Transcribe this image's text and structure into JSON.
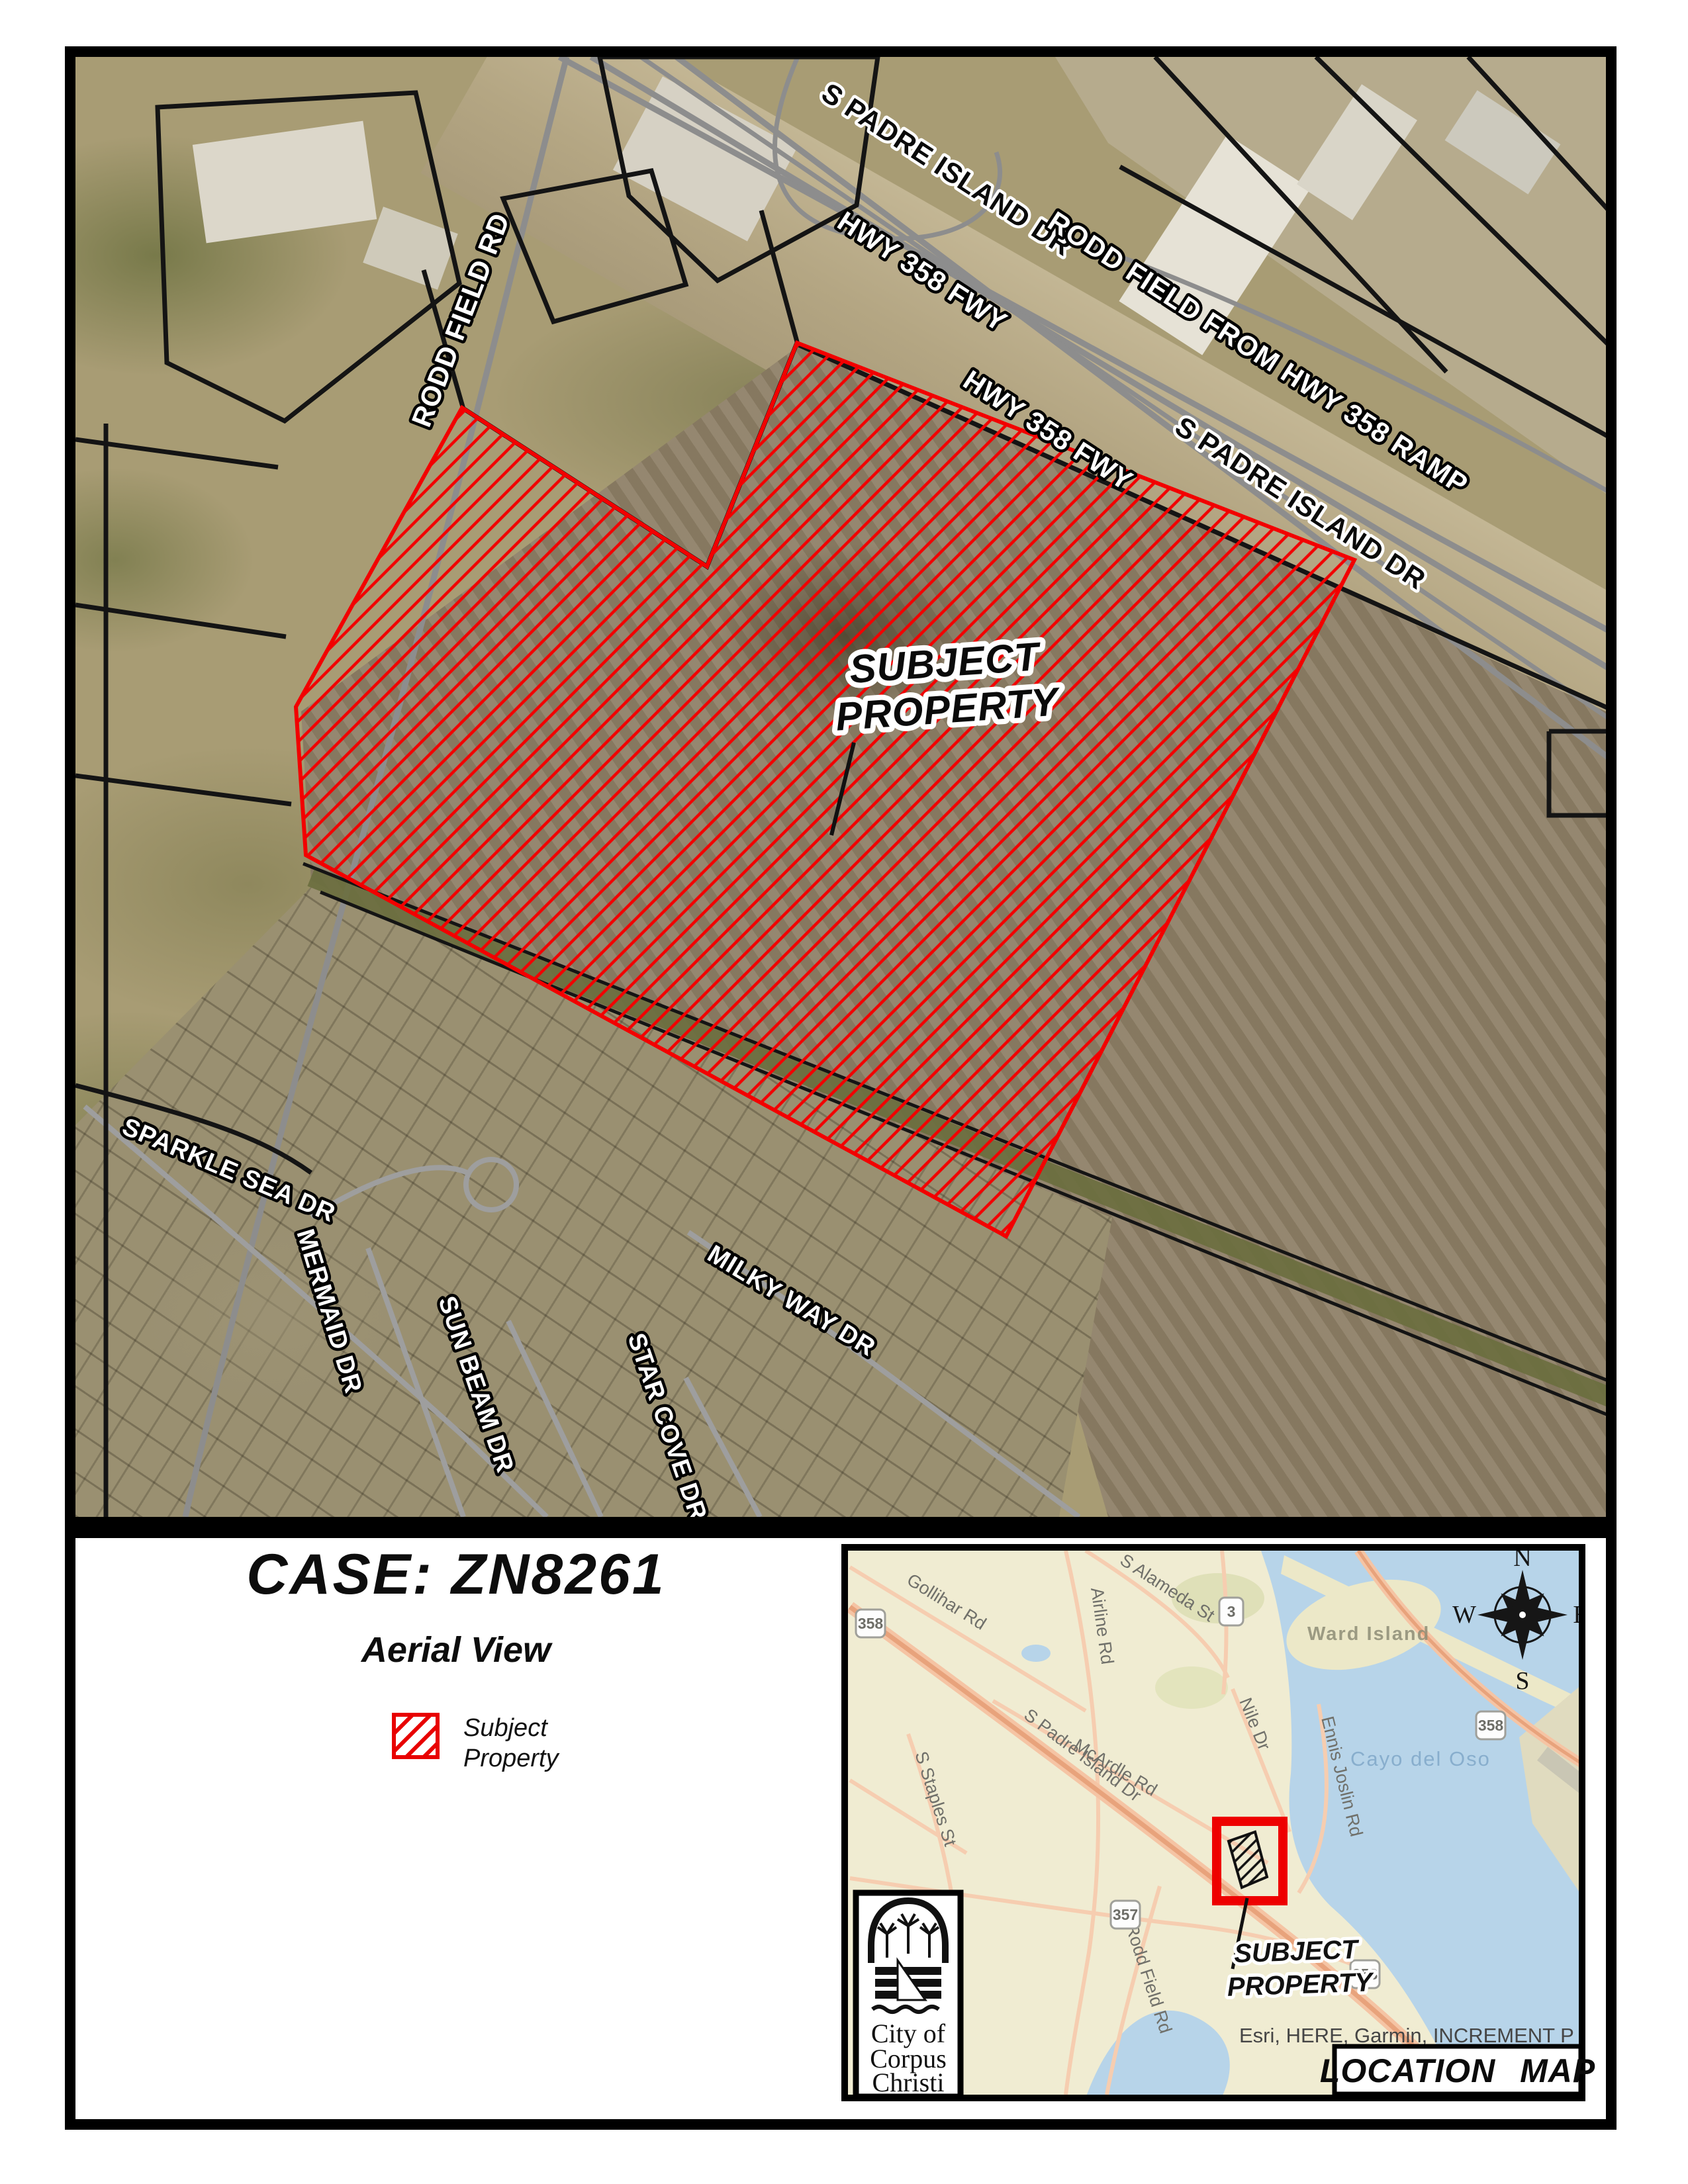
{
  "aerial": {
    "labels": {
      "spid_top": "S PADRE ISLAND DR",
      "hwy358_a": "HWY 358 FWY",
      "rodd_ramp": "RODD FIELD FROM HWY 358 RAMP",
      "hwy358_b": "HWY 358 FWY",
      "spid_right": "S PADRE ISLAND DR",
      "rodd_field_rd": "RODD FIELD RD",
      "sparkle_sea": "SPARKLE SEA DR",
      "mermaid": "MERMAID DR",
      "sun_beam": "SUN BEAM DR",
      "star_cove": "STAR COVE DR",
      "milky_way": "MILKY WAY DR",
      "subject_line1": "SUBJECT",
      "subject_line2": "PROPERTY"
    }
  },
  "panel": {
    "case_title": "CASE: ZN8261",
    "subtitle": "Aerial View",
    "legend": {
      "line1": "Subject",
      "line2": "Property"
    },
    "logo": {
      "line1": "City of",
      "line2": "Corpus",
      "line3": "Christi"
    }
  },
  "inset": {
    "title_box": "LOCATION MAP",
    "subject_line1": "SUBJECT",
    "subject_line2": "PROPERTY",
    "attribution_line1": "Esri, HERE, Garmin, INCREMENT P",
    "attribution_line2": "NGA, USGS",
    "water_label": "Cayo del Oso",
    "island_label": "Ward Island",
    "roads": {
      "gollihar": "Gollihar Rd",
      "airline": "Airline Rd",
      "alameda": "S Alameda St",
      "mcardle": "McArdle Rd",
      "nile": "Nile Dr",
      "ennis": "Ennis Joslin Rd",
      "staples": "S Staples St",
      "rodd_field": "Rodd Field Rd",
      "spid": "S Padre Island Dr"
    },
    "shields": {
      "s358_a": "358",
      "s3": "3",
      "s357": "357",
      "s358_b": "358",
      "s358_c": "358"
    },
    "compass": {
      "n": "N",
      "s": "S",
      "e": "E",
      "w": "W"
    }
  },
  "colors": {
    "hatch_red": "#ee0000",
    "parcel_black": "#141414",
    "road_gray": "#8d8d8d",
    "inset_land": "#f0ecd2",
    "inset_water": "#b7d4e9",
    "inset_highway": "#e8a37c"
  }
}
